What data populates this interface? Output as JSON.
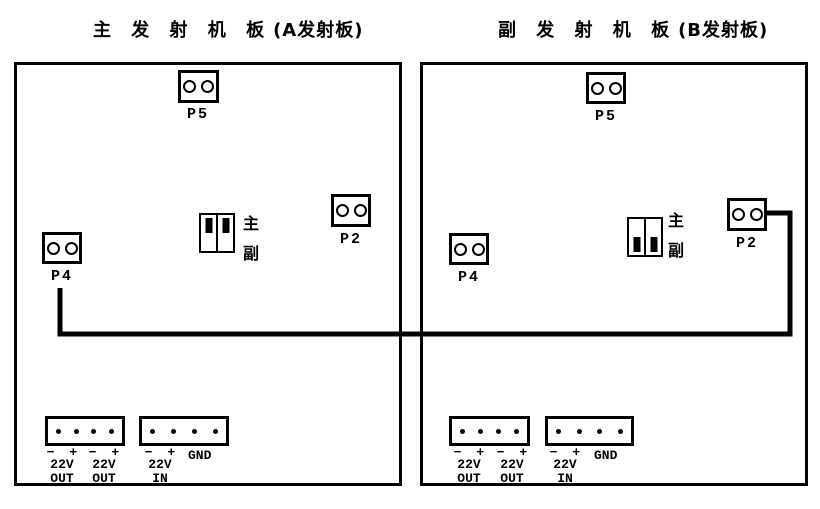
{
  "boards": [
    {
      "title_cjk": "主 发 射 机 板",
      "title_suffix": "(A发射板)",
      "connectors": {
        "p5": "P5",
        "p2": "P2",
        "p4": "P4"
      },
      "jumper": {
        "top_label": "主",
        "bottom_label": "副",
        "position": "top"
      },
      "power": [
        {
          "signs": "− +",
          "volt": "22V",
          "dir": "OUT"
        },
        {
          "signs": "− +",
          "volt": "22V",
          "dir": "OUT"
        },
        {
          "signs": "− +",
          "volt": "22V",
          "dir": "IN"
        }
      ],
      "gnd": "GND"
    },
    {
      "title_cjk": "副 发 射 机 板",
      "title_suffix": "(B发射板)",
      "connectors": {
        "p5": "P5",
        "p2": "P2",
        "p4": "P4"
      },
      "jumper": {
        "top_label": "主",
        "bottom_label": "副",
        "position": "bottom"
      },
      "power": [
        {
          "signs": "− +",
          "volt": "22V",
          "dir": "OUT"
        },
        {
          "signs": "− +",
          "volt": "22V",
          "dir": "OUT"
        },
        {
          "signs": "− +",
          "volt": "22V",
          "dir": "IN"
        }
      ],
      "gnd": "GND"
    }
  ]
}
